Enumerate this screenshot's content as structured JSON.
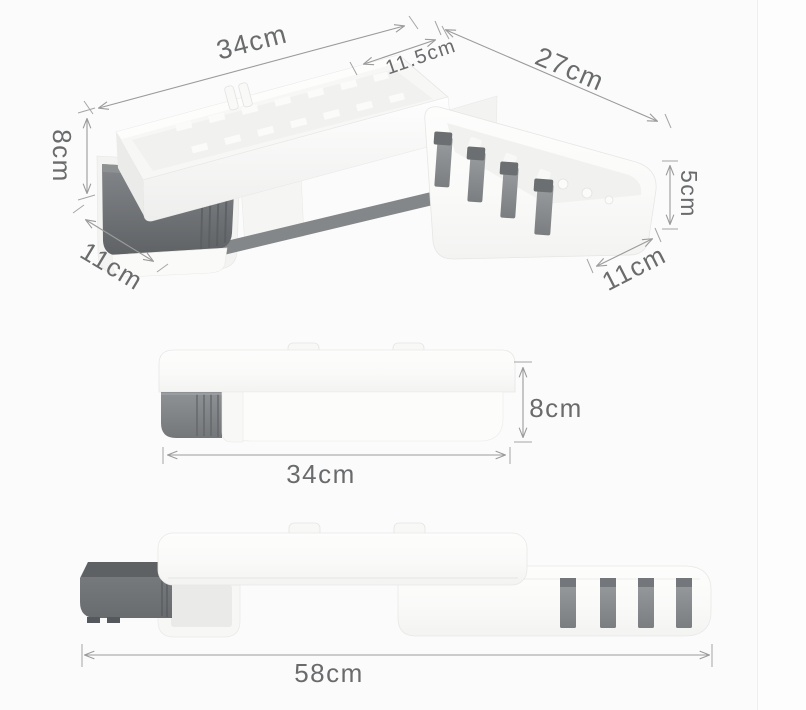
{
  "figure": {
    "description": "Rotating corner shelf organizer - product dimension diagram with three views",
    "unit": "cm"
  },
  "colors": {
    "background": "#fbfbfb",
    "dimension_line": "#9b9b9b",
    "dimension_text": "#6a6b6c",
    "product_white": "#fafaf9",
    "drawer_gray": "#6e7174",
    "hook_gray": "#8b8e91",
    "towel_bar_gray": "#84878a"
  },
  "views": {
    "perspective": {
      "dims": [
        {
          "id": "main-shelf-width",
          "label": "34cm"
        },
        {
          "id": "corner-tray-width",
          "label": "11.5cm"
        },
        {
          "id": "side-shelf-width",
          "label": "27cm"
        },
        {
          "id": "main-shelf-height",
          "label": "8cm"
        },
        {
          "id": "main-shelf-depth",
          "label": "11cm"
        },
        {
          "id": "side-shelf-height",
          "label": "5cm"
        },
        {
          "id": "side-shelf-depth",
          "label": "11cm"
        }
      ]
    },
    "front_closed": {
      "dims": [
        {
          "id": "width",
          "label": "34cm"
        },
        {
          "id": "height",
          "label": "8cm"
        }
      ]
    },
    "front_extended": {
      "dims": [
        {
          "id": "total-width",
          "label": "58cm"
        }
      ]
    }
  }
}
